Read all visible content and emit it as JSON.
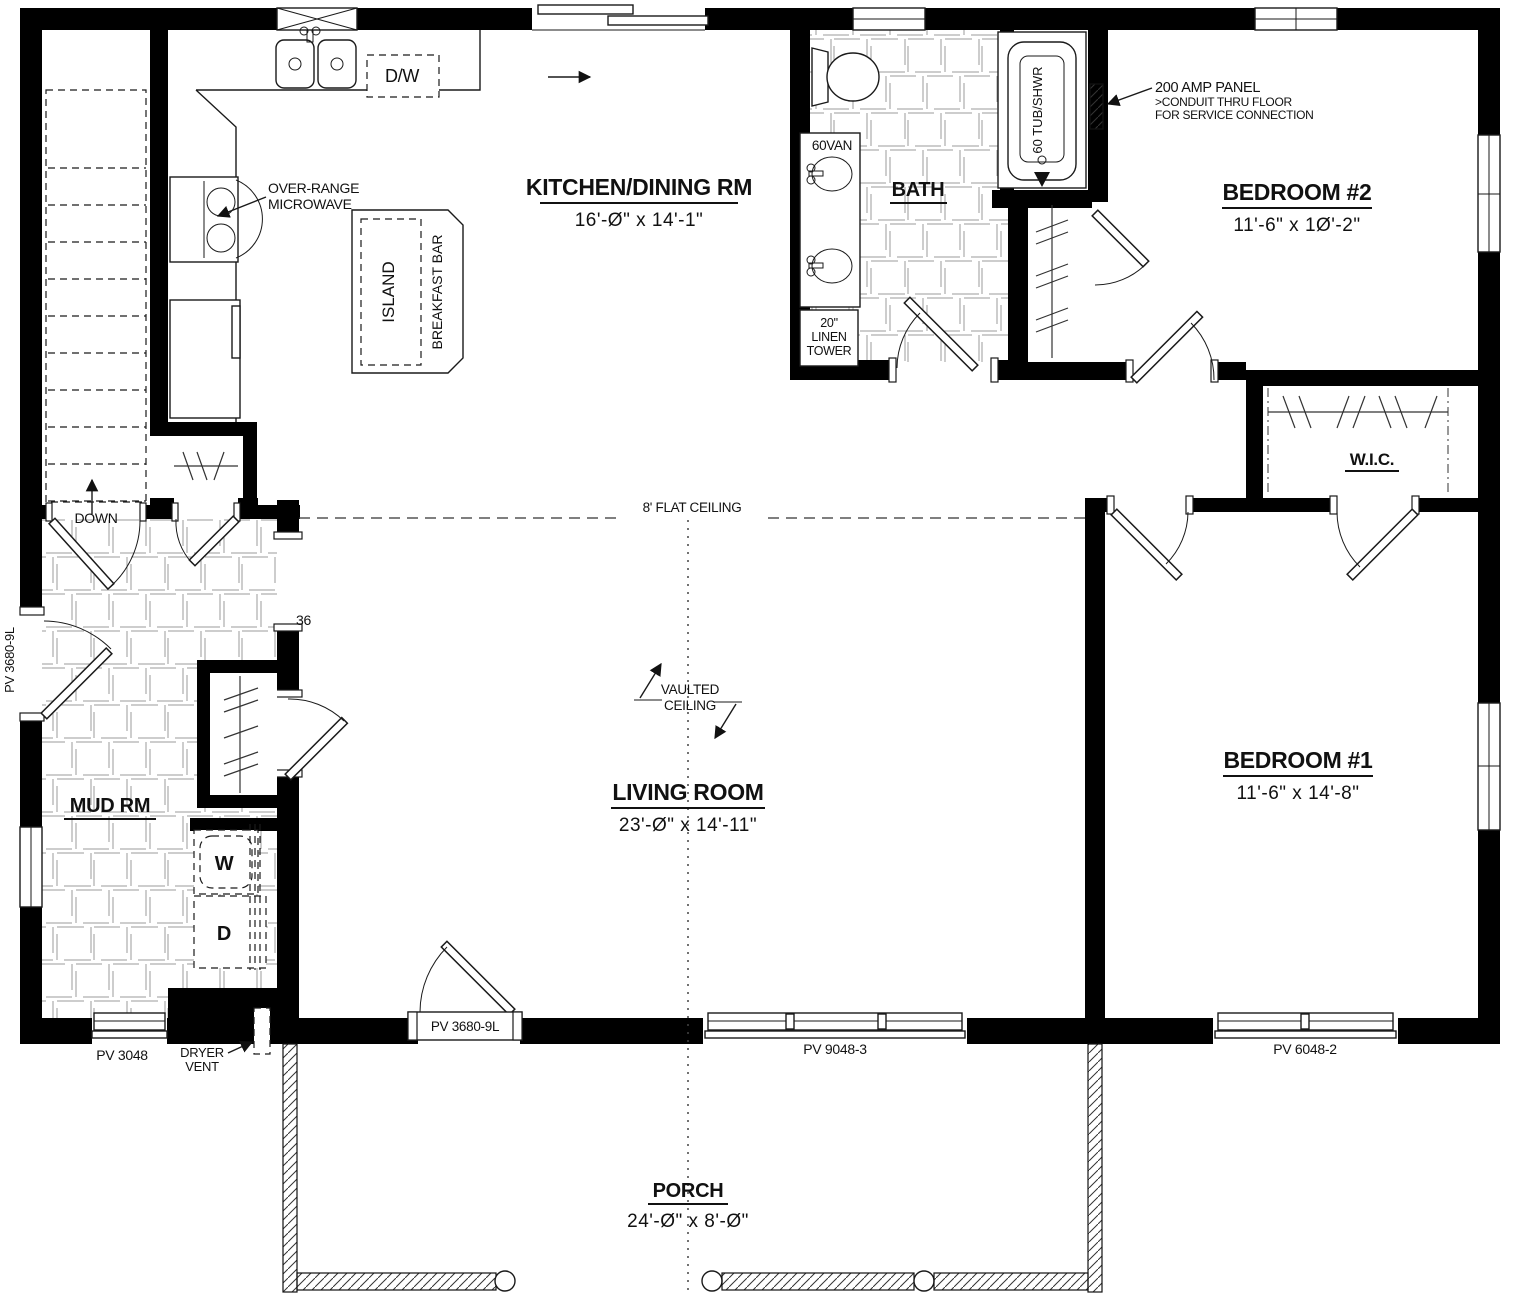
{
  "plan": {
    "rooms": {
      "kitchen": {
        "name": "KITCHEN/DINING RM",
        "dim": "16'-Ø\" x 14'-1\""
      },
      "bath": {
        "name": "BATH"
      },
      "bedroom2": {
        "name": "BEDROOM #2",
        "dim": "11'-6\" x 1Ø'-2\""
      },
      "wic": {
        "name": "W.I.C."
      },
      "mudroom": {
        "name": "MUD RM"
      },
      "living": {
        "name": "LIVING ROOM",
        "dim": "23'-Ø\" x 14'-11\""
      },
      "bedroom1": {
        "name": "BEDROOM #1",
        "dim": "11'-6\" x 14'-8\""
      },
      "porch": {
        "name": "PORCH",
        "dim": "24'-Ø\" x 8'-Ø\""
      }
    },
    "fixtures": {
      "dishwasher": "D/W",
      "island": "ISLAND",
      "breakfast_bar": "BREAKFAST BAR",
      "microwave_line1": "OVER-RANGE",
      "microwave_line2": "MICROWAVE",
      "vanity": "60VAN",
      "linen_line1": "20\"",
      "linen_line2": "LINEN",
      "linen_line3": "TOWER",
      "tub": "60 TUB/SHWR",
      "washer": "W",
      "dryer": "D",
      "dryer_vent_line1": "DRYER",
      "dryer_vent_line2": "VENT",
      "stairs": "DOWN"
    },
    "annotations": {
      "panel_line1": "200 AMP PANEL",
      "panel_line2": ">CONDUIT THRU FLOOR",
      "panel_line3": "FOR SERVICE CONNECTION",
      "flat_ceiling": "8' FLAT CEILING",
      "vaulted_line1": "VAULTED",
      "vaulted_line2": "CEILING",
      "opening_width": "36"
    },
    "openings": {
      "side_door": "PV 3680-9L",
      "mud_window": "PV 3048",
      "front_door": "PV 3680-9L",
      "living_window": "PV 9048-3",
      "bedroom1_window": "PV 6048-2"
    }
  }
}
